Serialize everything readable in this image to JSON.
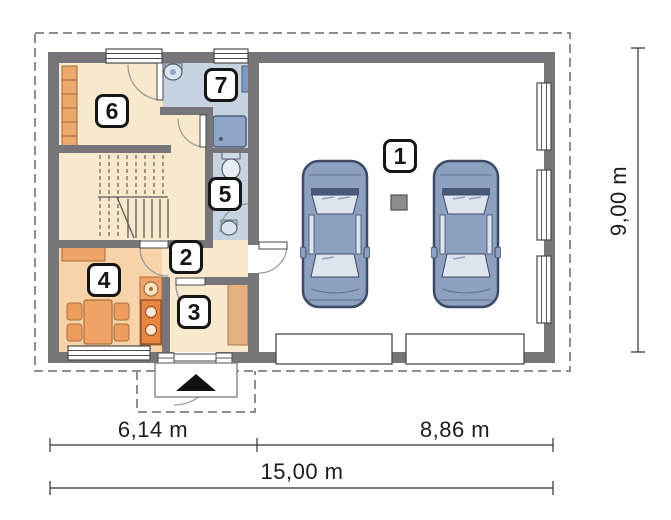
{
  "plan": {
    "rooms": [
      {
        "number": "1"
      },
      {
        "number": "2"
      },
      {
        "number": "3"
      },
      {
        "number": "4"
      },
      {
        "number": "5"
      },
      {
        "number": "6"
      },
      {
        "number": "7"
      }
    ],
    "dimensions": {
      "bottom_left": "6,14 m",
      "bottom_right": "8,86 m",
      "bottom_total": "15,00 m",
      "right_side": "9,00 m"
    },
    "colors": {
      "wall": "#75757a",
      "floor_cream": "#f9e9cc",
      "floor_warm": "#f8d2a8",
      "floor_bath": "#c7d2e0",
      "furniture_orange": "#f0a366",
      "stove_orange": "#e8853f",
      "car_body": "#8da0bf",
      "glass": "#dde4ee",
      "line_dark": "#1c1c1c"
    }
  }
}
